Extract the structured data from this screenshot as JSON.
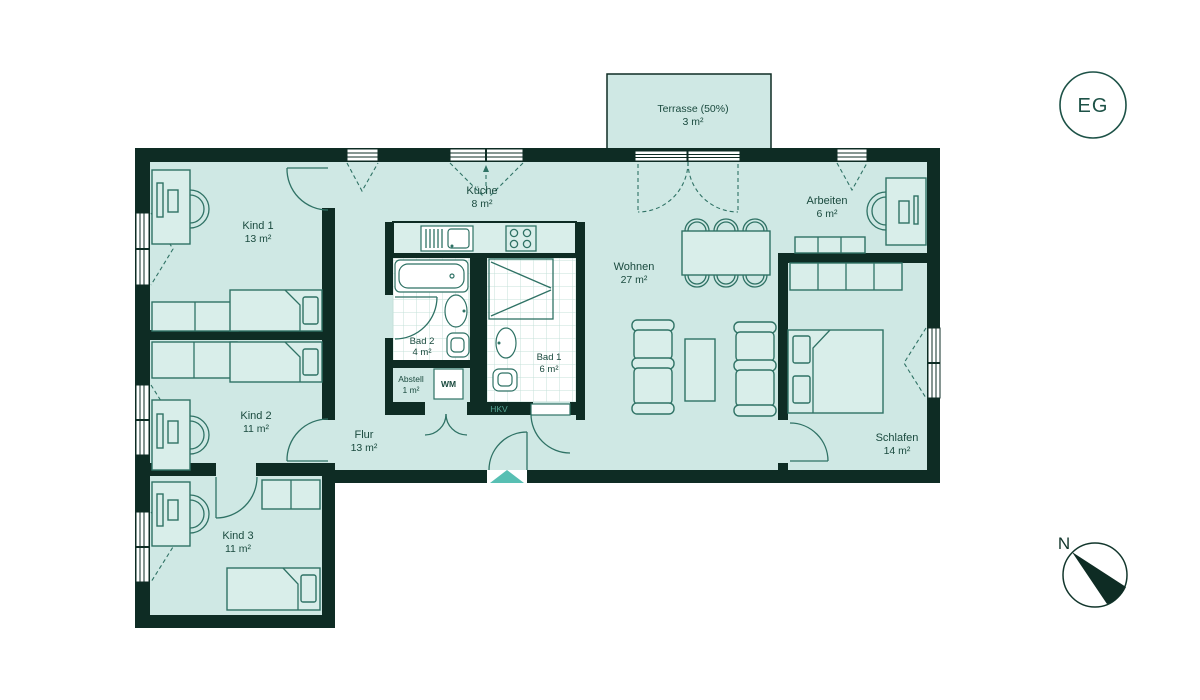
{
  "floor_badge": "EG",
  "compass": {
    "label": "N"
  },
  "rooms": [
    {
      "id": "kind1",
      "name": "Kind 1",
      "area": "13 m²"
    },
    {
      "id": "kind2",
      "name": "Kind 2",
      "area": "11 m²"
    },
    {
      "id": "kind3",
      "name": "Kind 3",
      "area": "11 m²"
    },
    {
      "id": "kueche",
      "name": "Küche",
      "area": "8 m²"
    },
    {
      "id": "bad2",
      "name": "Bad 2",
      "area": "4 m²"
    },
    {
      "id": "abstell",
      "name": "Abstell",
      "area": "1 m²"
    },
    {
      "id": "bad1",
      "name": "Bad 1",
      "area": "6 m²"
    },
    {
      "id": "flur",
      "name": "Flur",
      "area": "13 m²"
    },
    {
      "id": "wohnen",
      "name": "Wohnen",
      "area": "27 m²"
    },
    {
      "id": "arbeiten",
      "name": "Arbeiten",
      "area": "6 m²"
    },
    {
      "id": "schlafen",
      "name": "Schlafen",
      "area": "14 m²"
    },
    {
      "id": "terrasse",
      "name": "Terrasse (50%)",
      "area": "3 m²"
    }
  ],
  "fixtures": {
    "washing_machine": "WM",
    "heating_distributor": "HKV"
  },
  "colors": {
    "wall": "#0e2c24",
    "floor": "#cfe8e4",
    "furniture_fill": "#d9eeea",
    "furniture_line": "#2f7265",
    "entrance_accent": "#58bfb3",
    "label_text": "#1a4a3e",
    "tile_line": "#c4e1da"
  }
}
